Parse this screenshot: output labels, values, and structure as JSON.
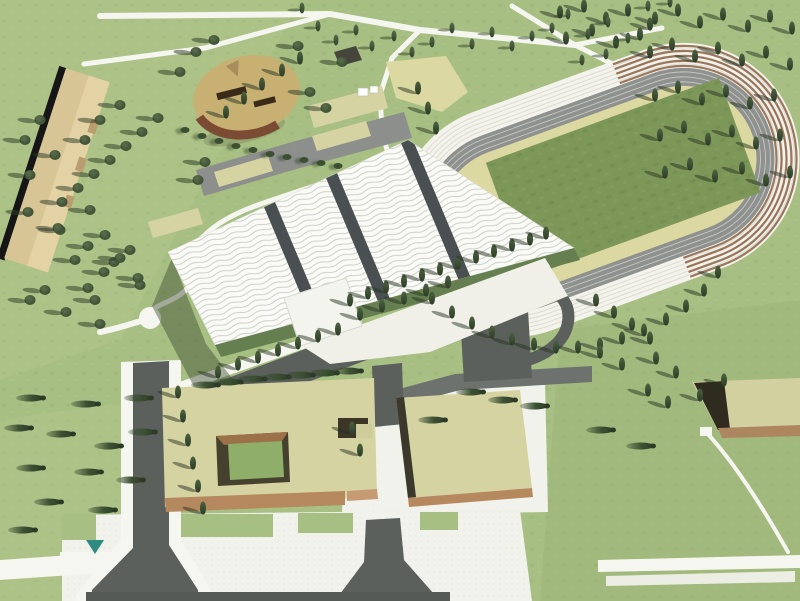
{
  "scene": {
    "kind": "aerial architectural rendering of a sports campus",
    "elements": {
      "stadium": "athletics stadium with oval running track, grandstand ring and green infield",
      "sports_hall": "large hall with white rippled wave roof and dark seam bands",
      "entrance_canopy": "small flat white entrance canopy at hall front",
      "long_building": "narrow tan slab building, upper left",
      "round_building": "rounded tan-roofed pavilion, upper left",
      "courtyard_building": "large khaki-roofed building with square green courtyard, lower left",
      "office_building": "khaki-roofed block on white plaza, lower centre",
      "small_building": "small khaki-roofed block at right edge",
      "parking": "dark asphalt parking lots and drop-off loop",
      "roads": "grey access roads with flared junctions",
      "paths": "white pedestrian paths and plaza",
      "vegetation": "cypress and round trees, grove grid at upper right"
    }
  },
  "palette": {
    "grass": "#a7bf82",
    "grass_light": "#bcca92",
    "grass_dark": "#96ad70",
    "field": "#7d9759",
    "apron": "#dbd8a1",
    "track": "#8e918e",
    "lane": "#c6c8c3",
    "stands": "#f3f3ec",
    "step_line": "#dcdcd4",
    "step_brown": "#8b6243",
    "roof_white": "#fafaf6",
    "roof_wave": "#c9c9c2",
    "roof_band": "#4a5052",
    "facade": "#667f50",
    "khaki": "#d6d3a2",
    "tan": "#d8c596",
    "tan_light": "#e3d2a4",
    "brown": "#b5885e",
    "brown_dark": "#7c4b33",
    "wall_dark": "#3a392c",
    "road": "#6e726e",
    "road_dark": "#5c605c",
    "path": "#f6f6f0",
    "plaza": "#f2f2ec",
    "tree": "#3a4c31",
    "teal": "#2f8c80",
    "shadow": "#3e4c33"
  },
  "trees": {
    "cyp": [
      [
        655,
        18
      ],
      [
        678,
        10
      ],
      [
        700,
        22
      ],
      [
        723,
        14
      ],
      [
        748,
        26
      ],
      [
        770,
        16
      ],
      [
        792,
        28
      ],
      [
        650,
        52
      ],
      [
        672,
        44
      ],
      [
        695,
        56
      ],
      [
        718,
        48
      ],
      [
        742,
        60
      ],
      [
        766,
        52
      ],
      [
        790,
        64
      ],
      [
        655,
        95
      ],
      [
        678,
        87
      ],
      [
        702,
        99
      ],
      [
        726,
        91
      ],
      [
        750,
        103
      ],
      [
        774,
        95
      ],
      [
        660,
        135
      ],
      [
        684,
        127
      ],
      [
        708,
        139
      ],
      [
        732,
        131
      ],
      [
        756,
        143
      ],
      [
        780,
        135
      ],
      [
        665,
        172
      ],
      [
        690,
        164
      ],
      [
        715,
        176
      ],
      [
        742,
        168
      ],
      [
        766,
        180
      ],
      [
        790,
        172
      ],
      [
        560,
        12
      ],
      [
        584,
        6
      ],
      [
        606,
        18
      ],
      [
        628,
        10
      ],
      [
        650,
        24
      ],
      [
        566,
        38
      ],
      [
        592,
        30
      ],
      [
        616,
        42
      ],
      [
        640,
        34
      ],
      [
        432,
        298
      ],
      [
        452,
        312
      ],
      [
        472,
        323
      ],
      [
        492,
        332
      ],
      [
        512,
        339
      ],
      [
        534,
        344
      ],
      [
        556,
        347
      ],
      [
        578,
        347
      ],
      [
        600,
        344
      ],
      [
        622,
        338
      ],
      [
        644,
        330
      ],
      [
        666,
        319
      ],
      [
        686,
        306
      ],
      [
        704,
        290
      ],
      [
        718,
        272
      ],
      [
        350,
        300
      ],
      [
        368,
        293
      ],
      [
        386,
        287
      ],
      [
        404,
        281
      ],
      [
        422,
        275
      ],
      [
        440,
        269
      ],
      [
        458,
        263
      ],
      [
        476,
        257
      ],
      [
        494,
        251
      ],
      [
        512,
        245
      ],
      [
        530,
        239
      ],
      [
        546,
        233
      ],
      [
        360,
        314
      ],
      [
        382,
        306
      ],
      [
        404,
        298
      ],
      [
        426,
        290
      ],
      [
        448,
        282
      ],
      [
        218,
        372
      ],
      [
        238,
        364
      ],
      [
        258,
        357
      ],
      [
        278,
        350
      ],
      [
        298,
        343
      ],
      [
        318,
        336
      ],
      [
        338,
        329
      ],
      [
        178,
        392
      ],
      [
        183,
        416
      ],
      [
        188,
        440
      ],
      [
        193,
        463
      ],
      [
        198,
        486
      ],
      [
        203,
        508
      ],
      [
        352,
        428
      ],
      [
        360,
        450
      ],
      [
        596,
        300
      ],
      [
        614,
        312
      ],
      [
        632,
        324
      ],
      [
        650,
        338
      ],
      [
        600,
        352
      ],
      [
        622,
        364
      ],
      [
        656,
        358
      ],
      [
        676,
        372
      ],
      [
        648,
        390
      ],
      [
        668,
        402
      ],
      [
        700,
        395
      ],
      [
        724,
        380
      ],
      [
        418,
        88
      ],
      [
        428,
        108
      ],
      [
        436,
        128
      ],
      [
        300,
        58
      ],
      [
        282,
        70
      ],
      [
        262,
        84
      ],
      [
        244,
        98
      ],
      [
        226,
        112
      ]
    ],
    "poplar": [
      [
        302,
        8
      ],
      [
        318,
        26
      ],
      [
        336,
        40
      ],
      [
        356,
        30
      ],
      [
        372,
        46
      ],
      [
        394,
        36
      ],
      [
        412,
        52
      ],
      [
        432,
        42
      ],
      [
        452,
        28
      ],
      [
        472,
        44
      ],
      [
        492,
        32
      ],
      [
        512,
        46
      ],
      [
        532,
        36
      ],
      [
        552,
        28
      ],
      [
        568,
        14
      ],
      [
        588,
        34
      ],
      [
        608,
        22
      ],
      [
        628,
        38
      ],
      [
        606,
        54
      ],
      [
        582,
        60
      ],
      [
        648,
        6
      ],
      [
        670,
        2
      ]
    ],
    "round": [
      [
        158,
        118
      ],
      [
        142,
        132
      ],
      [
        126,
        146
      ],
      [
        110,
        160
      ],
      [
        94,
        174
      ],
      [
        78,
        188
      ],
      [
        62,
        202
      ],
      [
        120,
        105
      ],
      [
        100,
        120
      ],
      [
        85,
        140
      ],
      [
        40,
        120
      ],
      [
        25,
        140
      ],
      [
        55,
        155
      ],
      [
        30,
        175
      ],
      [
        90,
        210
      ],
      [
        60,
        230
      ],
      [
        105,
        235
      ],
      [
        130,
        250
      ],
      [
        75,
        260
      ],
      [
        45,
        290
      ],
      [
        95,
        300
      ],
      [
        140,
        285
      ],
      [
        28,
        212
      ],
      [
        58,
        228
      ],
      [
        88,
        246
      ],
      [
        114,
        262
      ],
      [
        138,
        278
      ],
      [
        30,
        300
      ],
      [
        66,
        312
      ],
      [
        100,
        324
      ],
      [
        120,
        258
      ],
      [
        104,
        272
      ],
      [
        88,
        288
      ],
      [
        180,
        72
      ],
      [
        196,
        52
      ],
      [
        214,
        40
      ],
      [
        310,
        92
      ],
      [
        326,
        108
      ],
      [
        342,
        62
      ],
      [
        298,
        46
      ],
      [
        205,
        162
      ],
      [
        198,
        180
      ]
    ],
    "shrub": [
      [
        185,
        130
      ],
      [
        202,
        136
      ],
      [
        219,
        141
      ],
      [
        236,
        146
      ],
      [
        253,
        150
      ],
      [
        270,
        154
      ],
      [
        287,
        157
      ],
      [
        304,
        160
      ],
      [
        321,
        163
      ],
      [
        338,
        166
      ]
    ],
    "hcyp": [
      [
        30,
        398
      ],
      [
        85,
        404
      ],
      [
        138,
        398
      ],
      [
        18,
        428
      ],
      [
        60,
        434
      ],
      [
        108,
        446
      ],
      [
        142,
        432
      ],
      [
        30,
        468
      ],
      [
        88,
        472
      ],
      [
        130,
        480
      ],
      [
        48,
        502
      ],
      [
        102,
        510
      ],
      [
        22,
        530
      ],
      [
        205,
        385
      ],
      [
        228,
        382
      ],
      [
        252,
        379
      ],
      [
        276,
        377
      ],
      [
        300,
        375
      ],
      [
        324,
        373
      ],
      [
        348,
        371
      ],
      [
        470,
        392
      ],
      [
        502,
        400
      ],
      [
        534,
        406
      ],
      [
        600,
        430
      ],
      [
        640,
        446
      ],
      [
        432,
        420
      ]
    ]
  }
}
